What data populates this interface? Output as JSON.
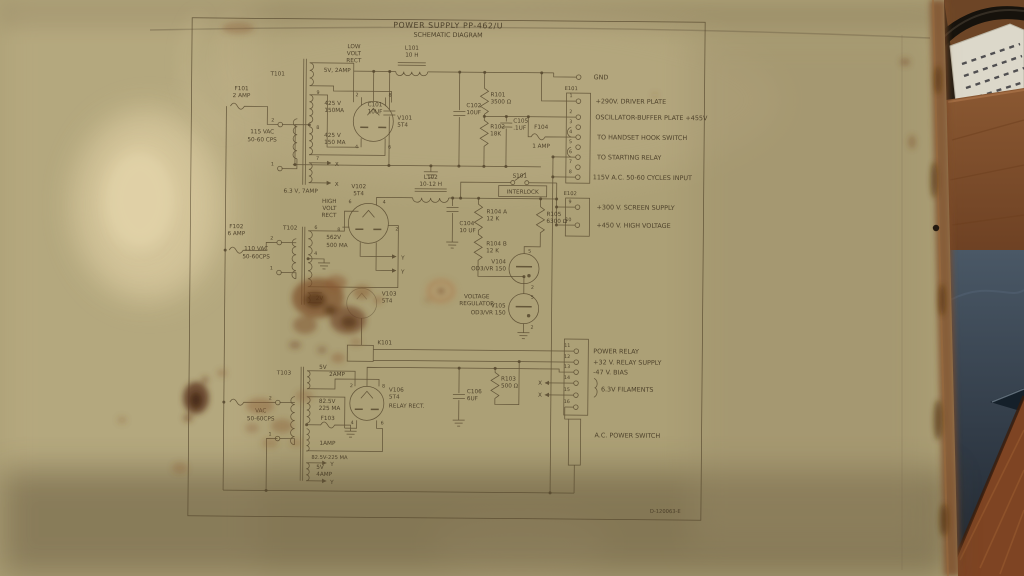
{
  "title": {
    "line1": "POWER SUPPLY PP-462/U",
    "line2": "SCHEMATIC DIAGRAM"
  },
  "drawing_number": "D-120063-E",
  "digits": {
    "1": "1",
    "2": "2",
    "4": "4",
    "5": "5",
    "6": "6",
    "7": "7",
    "8": "8",
    "9": "9"
  },
  "markers": {
    "x": "X",
    "y": "Y"
  },
  "terminals": {
    "gnd": "GND",
    "e101": {
      "name": "E101",
      "pins": [
        {
          "n": "1",
          "label": "+290V. DRIVER PLATE"
        },
        {
          "n": "2",
          "label": "OSCILLATOR-BUFFER PLATE +455V"
        },
        {
          "n": "3",
          "label": ""
        },
        {
          "n": "4",
          "label": "TO HANDSET HOOK SWITCH"
        },
        {
          "n": "5",
          "label": ""
        },
        {
          "n": "6",
          "label": "TO STARTING RELAY"
        },
        {
          "n": "7",
          "label": ""
        },
        {
          "n": "8",
          "label": "115V A.C. 50-60 CYCLES INPUT"
        }
      ]
    },
    "e102": {
      "name": "E102",
      "pins": [
        {
          "n": "9",
          "label": "+300 V. SCREEN SUPPLY"
        },
        {
          "n": "10",
          "label": "+450 V. HIGH VOLTAGE"
        }
      ]
    },
    "lower": {
      "pins": [
        {
          "n": "11",
          "label": "POWER RELAY"
        },
        {
          "n": "12",
          "label": "+32 V. RELAY SUPPLY"
        },
        {
          "n": "13",
          "label": "-47 V. BIAS"
        },
        {
          "n": "14",
          "label": ""
        },
        {
          "n": "15",
          "label": ""
        },
        {
          "n": "16",
          "label": ""
        }
      ],
      "filaments_label": "6.3V FILAMENTS",
      "ac_switch_label": "A.C. POWER SWITCH"
    }
  },
  "components": {
    "f101": {
      "d": "F101",
      "v": "2 AMP"
    },
    "t101": {
      "d": "T101",
      "primary1": "115 VAC",
      "primary2": "50-60 CPS",
      "w1": "5V, 2AMP",
      "w2a1": "425 V",
      "w2a2": "150MA",
      "w2b1": "425 V",
      "w2b2": "150 MA",
      "w3": "6.3 V, 7AMP"
    },
    "v101": {
      "d": "V101",
      "v": "5T4",
      "cap1": "LOW",
      "cap2": "VOLT",
      "cap3": "RECT"
    },
    "l101": {
      "d": "L101",
      "v": "10 H"
    },
    "c101": {
      "d": "C101",
      "v": "10UF"
    },
    "c102": {
      "d": "C102",
      "v": "10UF"
    },
    "r101": {
      "d": "R101",
      "v": "3500 Ω"
    },
    "r102": {
      "d": "R102",
      "v": "18K"
    },
    "c105": {
      "d": "C105",
      "v": ".1UF"
    },
    "f104": {
      "d": "F104",
      "v": "1 AMP"
    },
    "f102": {
      "d": "F102",
      "v": "6 AMP"
    },
    "t102": {
      "d": "T102",
      "primary1": "110 VAC",
      "primary2": "50-60CPS",
      "w11": "562V",
      "w12": "500 MA",
      "w2": "2V"
    },
    "v102": {
      "d": "V102",
      "v": "5T4",
      "cap1": "HIGH",
      "cap2": "VOLT",
      "cap3": "RECT"
    },
    "l102": {
      "d": "L102",
      "v": "10-12 H"
    },
    "s101": {
      "d": "S101",
      "v": "INTERLOCK"
    },
    "c104": {
      "d": "C104",
      "v": "10 UF"
    },
    "r104a": {
      "d": "R104 A",
      "v": "12 K"
    },
    "r104b": {
      "d": "R104 B",
      "v": "12 K"
    },
    "r105": {
      "d": "R105",
      "v": "6300 Ω"
    },
    "v104": {
      "d": "V104",
      "v": "OD3/VR 150"
    },
    "vreg": {
      "l1": "VOLTAGE",
      "l2": "REGULATOR"
    },
    "v105": {
      "d": "V105",
      "v": "OD3/VR 150"
    },
    "v103": {
      "d": "V103",
      "v": "5T4"
    },
    "k101": {
      "d": "K101"
    },
    "t103": {
      "d": "T103",
      "primary1": "VAC",
      "primary2": "50-60CPS",
      "w1a": "5V",
      "w1b": "2AMP",
      "w2a": "82.5V",
      "w2b": "225 MA",
      "w2line": "82.5V-225 MA",
      "w3a": "5V",
      "w3b": "4AMP"
    },
    "f103": {
      "d": "F103",
      "v": "1AMP"
    },
    "v106": {
      "d": "V106",
      "v": "5T4",
      "caption": "RELAY RECT."
    },
    "c106": {
      "d": "C106",
      "v": "6UF"
    },
    "r103": {
      "d": "R103",
      "v": "500 Ω"
    }
  }
}
